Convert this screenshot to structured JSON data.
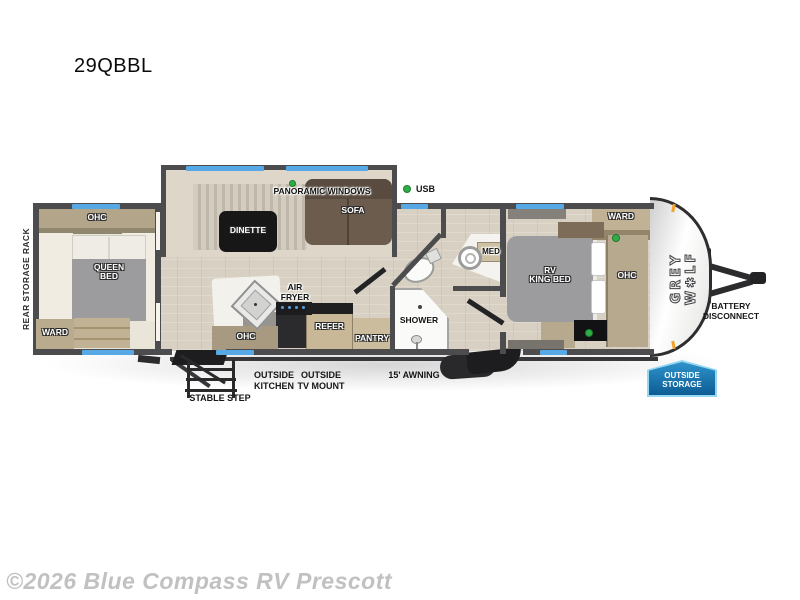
{
  "title": "29QBBL",
  "watermark": "©2026 Blue Compass RV Prescott",
  "colors": {
    "window_blue": "#57a9e6",
    "indicator_green": "#2fae47",
    "badge_blue": "#1b7ab8",
    "wall_gray": "#4c4c4e"
  },
  "floorplan": {
    "rear_storage_rack": "REAR STORAGE RACK",
    "rear_bedroom": {
      "ohc": "OHC",
      "bed": "QUEEN\nBED",
      "ward": "WARD"
    },
    "living": {
      "panoramic_windows": "PANORAMIC WINDOWS",
      "dinette": "DINETTE",
      "sofa": "SOFA",
      "usb": "USB"
    },
    "kitchen": {
      "air_fryer": "AIR\nFRYER",
      "ohc": "OHC",
      "refer": "REFER",
      "pantry": "PANTRY"
    },
    "bath": {
      "med": "MED",
      "shower": "SHOWER"
    },
    "front_bedroom": {
      "bed": "RV\nKING BED",
      "ward": "WARD",
      "ohc": "OHC"
    },
    "exterior": {
      "brand": "GREY W✱LF",
      "battery": "BATTERY\nDISCONNECT",
      "outside_storage": "OUTSIDE\nSTORAGE",
      "stable_step": "STABLE STEP",
      "outside_kitchen": "OUTSIDE\nKITCHEN",
      "outside_tv_mount": "OUTSIDE\nTV MOUNT",
      "awning": "15' AWNING"
    }
  }
}
